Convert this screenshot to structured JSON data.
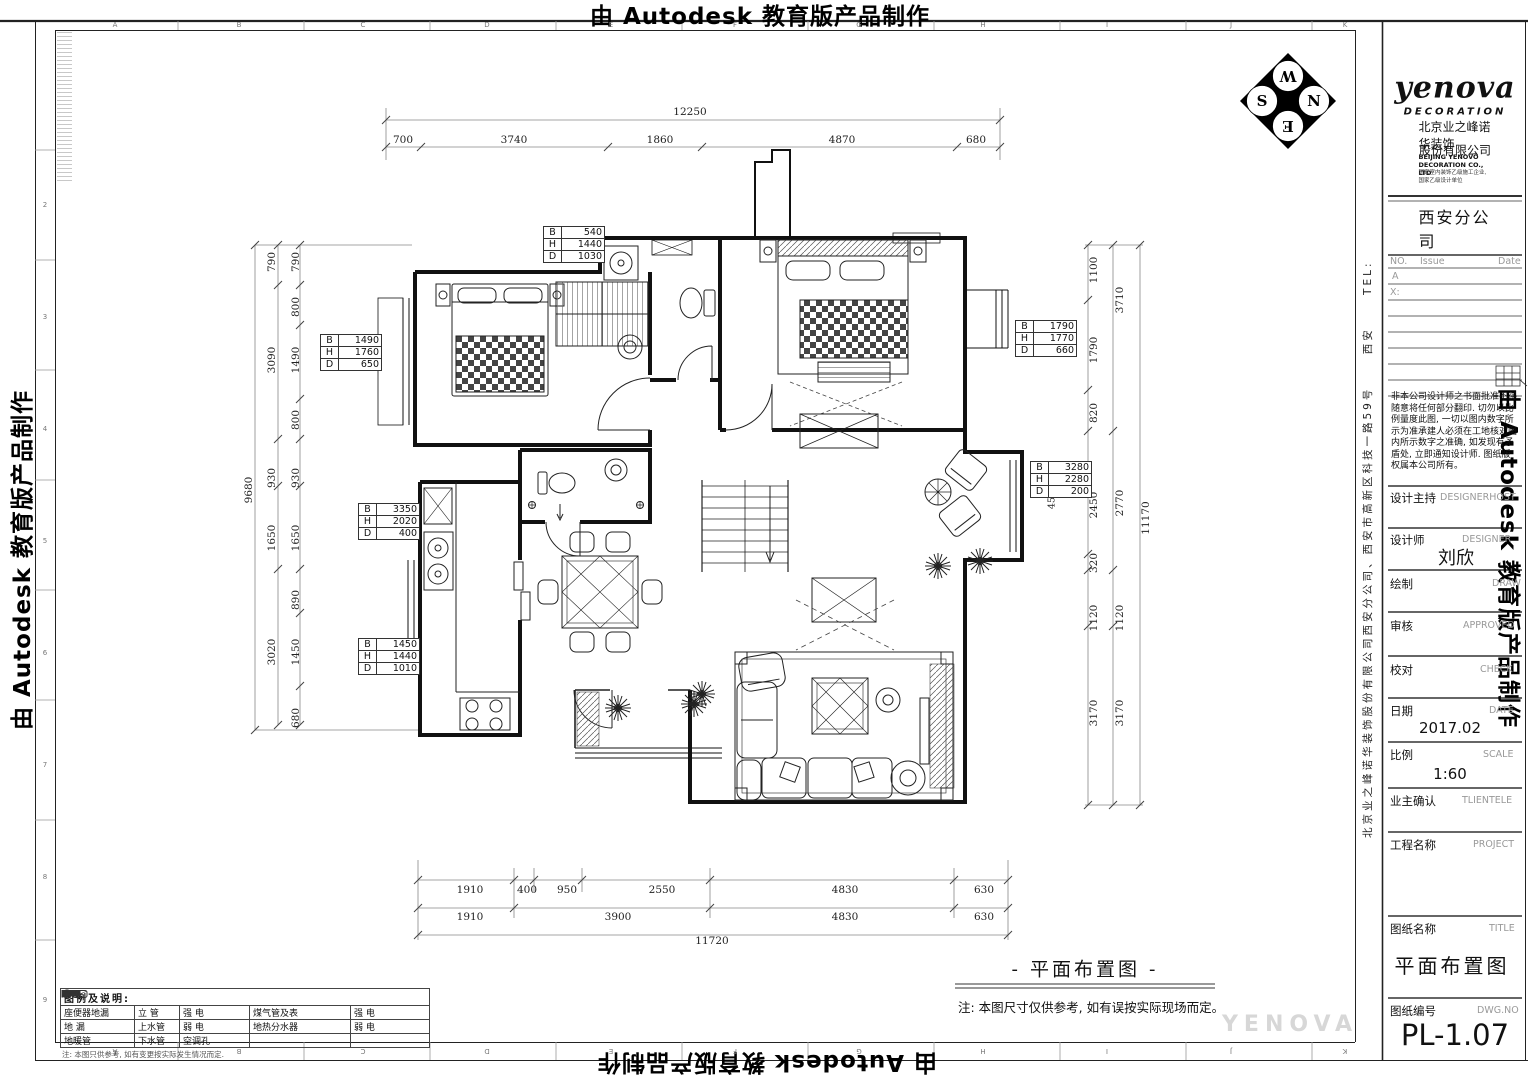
{
  "stamps": {
    "educational": "由 Autodesk 教育版产品制作"
  },
  "compass": {
    "north": "N",
    "south": "S",
    "east": "E",
    "west": "W"
  },
  "plan": {
    "title": "- 平面布置图 -",
    "note": "注: 本图尺寸仅供参考, 如有误按实际现场而定。",
    "watermark": "YENOVA"
  },
  "dimensions": {
    "top": {
      "overall": "12250",
      "segments": [
        "700",
        "3740",
        "1860",
        "4870",
        "680"
      ]
    },
    "left": {
      "overall": "9680",
      "mid": [
        "790",
        "3090",
        "930",
        "1650",
        "3020"
      ],
      "inner": [
        "790",
        "800",
        "1490",
        "800",
        "930",
        "1650",
        "890",
        "1450",
        "680"
      ]
    },
    "right": {
      "overall": "11170",
      "mid": [
        "3710",
        "2770",
        "1120",
        "3170"
      ],
      "inner": [
        "1100",
        "1790",
        "820",
        "2450",
        "320",
        "1120",
        "3170"
      ],
      "extra": "450"
    },
    "bottom": {
      "overall": "11720",
      "row1": [
        "1910",
        "400",
        "950",
        "2550",
        "4830",
        "630"
      ],
      "row2": [
        "1910",
        "3900",
        "4830",
        "630"
      ]
    }
  },
  "furniture_tables": {
    "headers": [
      "B",
      "H",
      "D"
    ],
    "tables": [
      {
        "B": "540",
        "H": "1440",
        "D": "1030"
      },
      {
        "B": "1490",
        "H": "1760",
        "D": "650"
      },
      {
        "B": "1790",
        "H": "1770",
        "D": "660"
      },
      {
        "B": "3350",
        "H": "2020",
        "D": "400"
      },
      {
        "B": "3280",
        "H": "2280",
        "D": "200"
      },
      {
        "B": "1450",
        "H": "1440",
        "D": "1010"
      }
    ]
  },
  "legend": {
    "title": "图例及说明:",
    "note": "注: 本图只供参考, 如有变更按实际发生情况而定.",
    "items": [
      {
        "icon": "toilet-floor-drain-icon",
        "label": "座便器地漏"
      },
      {
        "icon": "riser-pipe-icon",
        "label": "立 管"
      },
      {
        "icon": "strong-electric-icon",
        "label": "强 电"
      },
      {
        "icon": "gas-pipe-meter-icon",
        "label": "煤气管及表"
      },
      {
        "icon": "strong-electric-icon",
        "label": "强 电"
      },
      {
        "icon": "floor-drain-icon",
        "label": "地 漏"
      },
      {
        "icon": "water-supply-pipe-icon",
        "label": "上水管"
      },
      {
        "icon": "weak-electric-icon",
        "label": "弱 电"
      },
      {
        "icon": "floor-heating-manifold-icon",
        "label": "地热分水器"
      },
      {
        "icon": "weak-electric-icon",
        "label": "弱 电"
      },
      {
        "icon": "floor-heating-pipe-icon",
        "label": "地暖管"
      },
      {
        "icon": "drain-pipe-icon",
        "label": "下水管"
      },
      {
        "icon": "ac-hole-icon",
        "label": "空调孔"
      }
    ]
  },
  "titleblock": {
    "brand": {
      "logo": "yenova",
      "logo_sub": "DECORATION",
      "company_cn_1": "北京业之峰诺华装饰",
      "company_cn_2": "股份有限公司",
      "company_en": "BEIJING YENOVO DECORATION CO., LTD",
      "certs": "国家室内装饰乙级施工企业, 国家乙级设计单位"
    },
    "branch": "西安分公司",
    "issue_table": {
      "no": "NO.",
      "issue": "Issue",
      "date": "Date",
      "row_a": "A",
      "row_x": "X:"
    },
    "disclaimer": "非本公司设计师之书面批准不得随意将任何部分翻印. 切勿以比例量度此图, 一切以图内数字所示为准承建人必须在工地核对图内所示数字之准确, 如发现有矛盾处, 立即通知设计师. 图纸版权属本公司所有。",
    "fields": [
      {
        "label": "设计主持",
        "en": "DESIGNERHOST",
        "value": ""
      },
      {
        "label": "设计师",
        "en": "DESIGNER",
        "value": "刘欣"
      },
      {
        "label": "绘制",
        "en": "DRAW",
        "value": ""
      },
      {
        "label": "审核",
        "en": "APPROVED",
        "value": ""
      },
      {
        "label": "校对",
        "en": "CHECK",
        "value": ""
      },
      {
        "label": "日期",
        "en": "DATE",
        "value": "2017.02"
      },
      {
        "label": "比例",
        "en": "SCALE",
        "value": "1:60"
      },
      {
        "label": "业主确认",
        "en": "TLIENTELE",
        "value": ""
      },
      {
        "label": "工程名称",
        "en": "PROJECT",
        "value": ""
      },
      {
        "label": "图纸名称",
        "en": "TITLE",
        "value": "平面布置图"
      },
      {
        "label": "图纸编号",
        "en": "DWG.NO",
        "value": "PL-1.07"
      }
    ],
    "side_text": "北京业之峰诺华装饰股份有限公司西安分公司、西安市高新区科技一路59号",
    "side_city": "西安",
    "side_tel": "TEL:"
  },
  "grid_refs": {
    "top": [
      "A",
      "B",
      "C",
      "D",
      "E",
      "F",
      "G",
      "H",
      "I",
      "J",
      "K"
    ],
    "left": [
      "2",
      "3",
      "4",
      "5",
      "6",
      "7",
      "8",
      "9"
    ]
  }
}
